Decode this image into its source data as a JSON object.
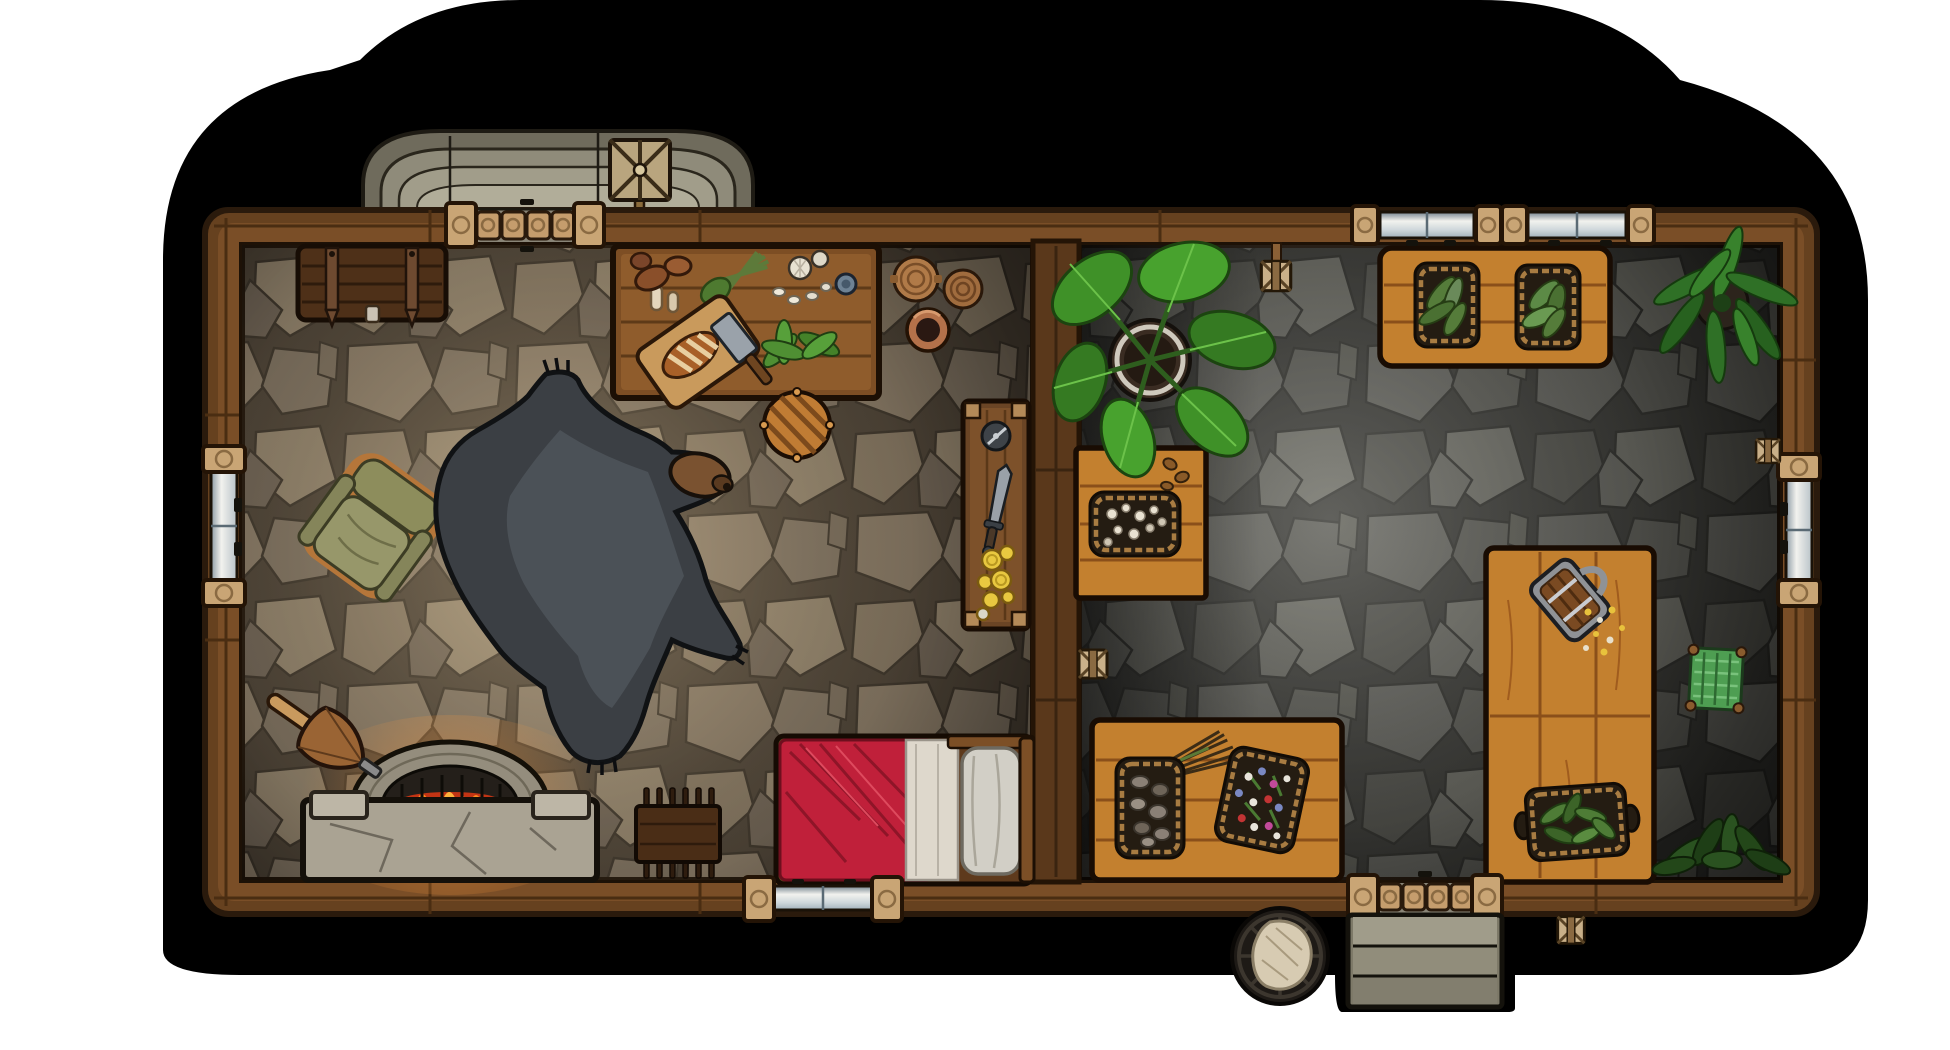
{
  "scene": {
    "title": "Top-down fantasy battlemap of a two-room stone cottage",
    "style": "hand-drawn VTT map, no visible text",
    "rooms": [
      {
        "id": "left_room",
        "label": "living room with hearth",
        "floor": "warm tan flagstones"
      },
      {
        "id": "right_room",
        "label": "herbalist storage room",
        "floor": "cool grey flagstones"
      }
    ]
  },
  "palette": {
    "page_bg": "#ffffff",
    "backdrop": "#000000",
    "wall_wood": "#7a4e27",
    "wall_wood_dark": "#66411f",
    "wall_outline": "#2a1a0c",
    "wall_seam": "#4a2d12",
    "divider": "#5a381b",
    "porch_stone": "#8f8b7a",
    "door_post": "#c9a575",
    "door_log": "#c59d6d",
    "glass": "#eef0ee",
    "glass_top": "#72808c",
    "floor_left_grout": "#4a4034",
    "floor_right_grout": "#333330",
    "chest": "#4e3018",
    "table_brown": "#7d4e24",
    "table_orange": "#c3802f",
    "plank_orange": "#8a4f1a",
    "rug_fur": "#3b3f44",
    "rug_fur_light": "#4f555b",
    "bear_head": "#7a5230",
    "chair_frame": "#b5763a",
    "chair_cushion": "#90905f",
    "bed_red": "#c0203a",
    "bed_sheet": "#ded8cc",
    "pillow": "#d2cfc6",
    "fire_orange": "#ff8a1e",
    "fireplace_stone": "#aaa393",
    "leaf_green": "#3f9128",
    "fern_green": "#2f7026",
    "herb_green": "#557c3a",
    "tray_dark": "#241c12",
    "rope": "#a87c42",
    "coin_gold": "#e8c840",
    "metal": "#9aa1a8",
    "rug_green": "#4e9e52",
    "barrel_sack": "#d7cbb2"
  },
  "objects": {
    "backdrop": {
      "label": "black map backdrop with stepped rounded corners"
    },
    "porch": {
      "label": "curved stone stoop outside the north door"
    },
    "weather_vane": {
      "label": "x-braced frame ornament on north wall"
    },
    "building": {
      "label": "timber-framed cottage shell"
    },
    "divider_wall": {
      "label": "interior plank wall separating the rooms"
    },
    "front_door": {
      "label": "log-plank door in north wall"
    },
    "back_door": {
      "label": "log-plank door in south wall to stone steps"
    },
    "window_west": {
      "label": "shuttered glass window, west wall"
    },
    "window_east": {
      "label": "shuttered glass window, east wall"
    },
    "window_south": {
      "label": "glass window in south wall behind bed"
    },
    "windows_north": {
      "label": "pair of glass windows in north wall"
    },
    "chest": {
      "label": "banded wooden chest"
    },
    "prep_table": {
      "label": "kitchen prep table with mushrooms, leeks, garlic, cup, cutting board with bread and cleaver, herbs"
    },
    "pottery": {
      "label": "two wooden plates and a clay bowl"
    },
    "stool": {
      "label": "round plank stool"
    },
    "armchair": {
      "label": "olive upholstered armchair"
    },
    "bear_rug": {
      "label": "black bear skin rug"
    },
    "wall_table": {
      "label": "narrow wall table with compass, dagger and gold coins"
    },
    "fireplace": {
      "label": "stone hearth with burning fire"
    },
    "bellows": {
      "label": "fireplace bellows"
    },
    "bed": {
      "label": "single bed with red blanket, white sheet and pillow"
    },
    "peg_bench": {
      "label": "small pegged work bench"
    },
    "monstera_plant": {
      "label": "large potted broadleaf plant"
    },
    "flower_crate": {
      "label": "crate with basket of white blossoms and acorns"
    },
    "herb_planter_table": {
      "label": "table with two baskets of growing herbs"
    },
    "fern_plant": {
      "label": "potted fern"
    },
    "herb_table": {
      "label": "drying table with herb bundle, mushroom tray and flower tray"
    },
    "long_table": {
      "label": "long work table with tankard, crumbs and herb tray"
    },
    "green_rug": {
      "label": "small woven green mat"
    },
    "dark_plant": {
      "label": "leafy floor plant in south-east corner"
    },
    "barrel": {
      "label": "open barrel with grain sack"
    },
    "stone_steps": {
      "label": "stone steps outside the south door"
    },
    "sconces": {
      "label": "small wall-mounted lamp brackets"
    }
  }
}
